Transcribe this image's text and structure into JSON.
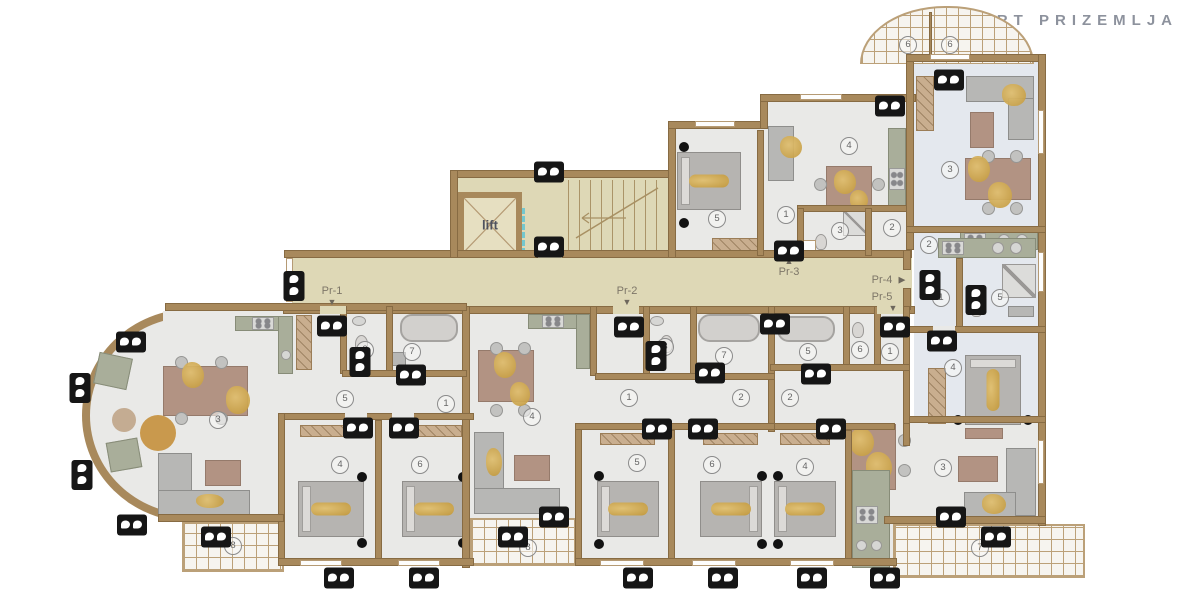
{
  "title": "TLOCRT PRIZEMLJA",
  "lift_label": "lift",
  "colors": {
    "wall": "#a8895c",
    "corridor_floor": "#ded8b6",
    "apartment_floor": "#e9e9e7",
    "blue_apartment_floor": "#e4e8ee",
    "tile_line": "#bba078",
    "gold_accent": "#c1973a",
    "camera": "#161616",
    "title_text": "#8d929d",
    "label_text": "#7d7668"
  },
  "entrances": [
    {
      "label": "Pr-1",
      "x": 332,
      "y": 291,
      "arrow": "▼",
      "ax": 332,
      "ay": 302
    },
    {
      "label": "Pr-2",
      "x": 627,
      "y": 291,
      "arrow": "▼",
      "ax": 627,
      "ay": 302
    },
    {
      "label": "Pr-3",
      "x": 789,
      "y": 272,
      "arrow": "▲",
      "ax": 789,
      "ay": 261
    },
    {
      "label": "Pr-4",
      "x": 882,
      "y": 280,
      "arrow": "▶",
      "ax": 902,
      "ay": 280
    },
    {
      "label": "Pr-5",
      "x": 882,
      "y": 297,
      "arrow": "▼",
      "ax": 893,
      "ay": 308
    }
  ],
  "room_markers": [
    {
      "n": "6",
      "x": 908,
      "y": 45
    },
    {
      "n": "6",
      "x": 950,
      "y": 45
    },
    {
      "n": "5",
      "x": 717,
      "y": 219
    },
    {
      "n": "1",
      "x": 786,
      "y": 215
    },
    {
      "n": "3",
      "x": 840,
      "y": 231
    },
    {
      "n": "2",
      "x": 892,
      "y": 228
    },
    {
      "n": "4",
      "x": 849,
      "y": 146
    },
    {
      "n": "3",
      "x": 950,
      "y": 170
    },
    {
      "n": "2",
      "x": 929,
      "y": 245
    },
    {
      "n": "1",
      "x": 941,
      "y": 298
    },
    {
      "n": "5",
      "x": 1000,
      "y": 298
    },
    {
      "n": "4",
      "x": 953,
      "y": 368
    },
    {
      "n": "3",
      "x": 218,
      "y": 420
    },
    {
      "n": "2",
      "x": 365,
      "y": 350
    },
    {
      "n": "7",
      "x": 412,
      "y": 352
    },
    {
      "n": "5",
      "x": 345,
      "y": 399
    },
    {
      "n": "1",
      "x": 446,
      "y": 404
    },
    {
      "n": "4",
      "x": 340,
      "y": 465
    },
    {
      "n": "6",
      "x": 420,
      "y": 465
    },
    {
      "n": "8",
      "x": 233,
      "y": 546
    },
    {
      "n": "4",
      "x": 532,
      "y": 417
    },
    {
      "n": "1",
      "x": 629,
      "y": 398
    },
    {
      "n": "3",
      "x": 665,
      "y": 347
    },
    {
      "n": "7",
      "x": 724,
      "y": 356
    },
    {
      "n": "2",
      "x": 741,
      "y": 398
    },
    {
      "n": "5",
      "x": 637,
      "y": 463
    },
    {
      "n": "6",
      "x": 712,
      "y": 465
    },
    {
      "n": "8",
      "x": 528,
      "y": 548
    },
    {
      "n": "2",
      "x": 790,
      "y": 398
    },
    {
      "n": "5",
      "x": 808,
      "y": 352
    },
    {
      "n": "6",
      "x": 860,
      "y": 350
    },
    {
      "n": "1",
      "x": 890,
      "y": 352
    },
    {
      "n": "4",
      "x": 805,
      "y": 467
    },
    {
      "n": "3",
      "x": 943,
      "y": 468
    },
    {
      "n": "7",
      "x": 980,
      "y": 548
    }
  ],
  "cameras": [
    {
      "x": 549,
      "y": 172,
      "o": "h"
    },
    {
      "x": 549,
      "y": 247,
      "o": "h"
    },
    {
      "x": 789,
      "y": 251,
      "o": "h"
    },
    {
      "x": 890,
      "y": 106,
      "o": "h"
    },
    {
      "x": 949,
      "y": 80,
      "o": "h"
    },
    {
      "x": 131,
      "y": 342,
      "o": "h"
    },
    {
      "x": 80,
      "y": 388,
      "o": "v"
    },
    {
      "x": 82,
      "y": 475,
      "o": "v"
    },
    {
      "x": 132,
      "y": 525,
      "o": "h"
    },
    {
      "x": 216,
      "y": 537,
      "o": "h"
    },
    {
      "x": 294,
      "y": 286,
      "o": "v"
    },
    {
      "x": 332,
      "y": 326,
      "o": "h"
    },
    {
      "x": 360,
      "y": 362,
      "o": "v"
    },
    {
      "x": 411,
      "y": 375,
      "o": "h"
    },
    {
      "x": 629,
      "y": 327,
      "o": "h"
    },
    {
      "x": 656,
      "y": 356,
      "o": "v"
    },
    {
      "x": 710,
      "y": 373,
      "o": "h"
    },
    {
      "x": 816,
      "y": 374,
      "o": "h"
    },
    {
      "x": 775,
      "y": 324,
      "o": "h"
    },
    {
      "x": 895,
      "y": 327,
      "o": "h"
    },
    {
      "x": 930,
      "y": 285,
      "o": "v"
    },
    {
      "x": 976,
      "y": 300,
      "o": "v"
    },
    {
      "x": 942,
      "y": 341,
      "o": "h"
    },
    {
      "x": 358,
      "y": 428,
      "o": "h"
    },
    {
      "x": 404,
      "y": 428,
      "o": "h"
    },
    {
      "x": 657,
      "y": 429,
      "o": "h"
    },
    {
      "x": 703,
      "y": 429,
      "o": "h"
    },
    {
      "x": 831,
      "y": 429,
      "o": "h"
    },
    {
      "x": 951,
      "y": 517,
      "o": "h"
    },
    {
      "x": 513,
      "y": 537,
      "o": "h"
    },
    {
      "x": 554,
      "y": 517,
      "o": "h"
    },
    {
      "x": 996,
      "y": 537,
      "o": "h"
    },
    {
      "x": 339,
      "y": 578,
      "o": "h"
    },
    {
      "x": 424,
      "y": 578,
      "o": "h"
    },
    {
      "x": 638,
      "y": 578,
      "o": "h"
    },
    {
      "x": 723,
      "y": 578,
      "o": "h"
    },
    {
      "x": 812,
      "y": 578,
      "o": "h"
    },
    {
      "x": 885,
      "y": 578,
      "o": "h"
    }
  ]
}
